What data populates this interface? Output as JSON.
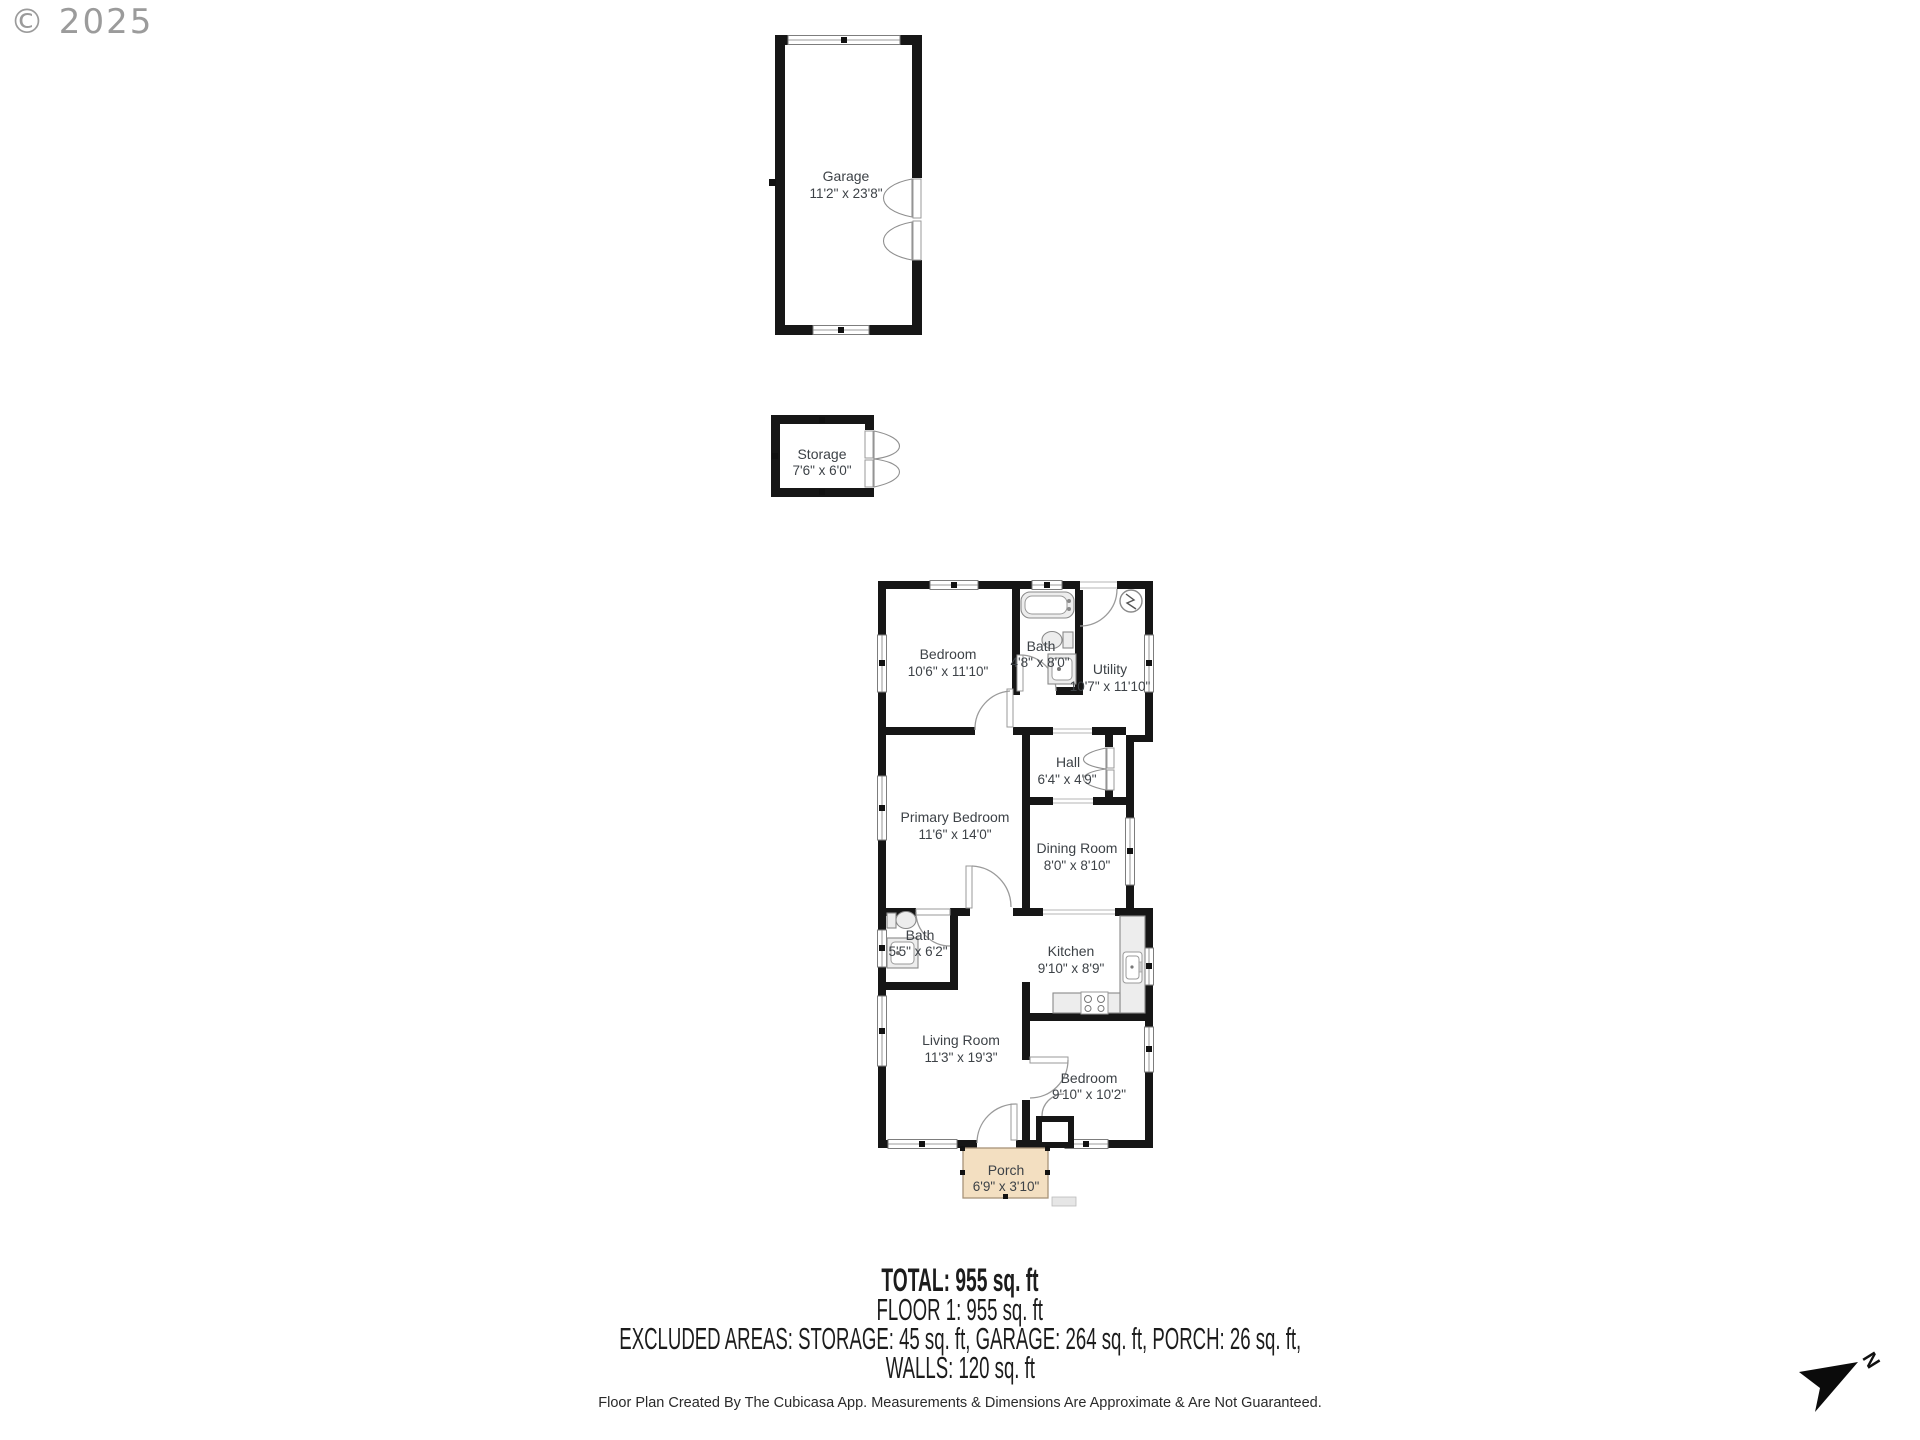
{
  "watermark": {
    "text": "© 2025"
  },
  "floor_plan": {
    "rooms": {
      "garage": {
        "name": "Garage",
        "dims": "11'2\" x 23'8\""
      },
      "storage": {
        "name": "Storage",
        "dims": "7'6\" x 6'0\""
      },
      "bedroom_top": {
        "name": "Bedroom",
        "dims": "10'6\" x 11'10\""
      },
      "bath_top": {
        "name": "Bath",
        "dims": "4'8\" x 8'0\""
      },
      "utility": {
        "name": "Utility",
        "dims": "10'7\" x 11'10\""
      },
      "hall": {
        "name": "Hall",
        "dims": "6'4\" x 4'9\""
      },
      "primary_bedroom": {
        "name": "Primary Bedroom",
        "dims": "11'6\" x 14'0\""
      },
      "dining_room": {
        "name": "Dining Room",
        "dims": "8'0\" x 8'10\""
      },
      "bath_lower": {
        "name": "Bath",
        "dims": "5'5\" x 6'2\""
      },
      "kitchen": {
        "name": "Kitchen",
        "dims": "9'10\" x 8'9\""
      },
      "living_room": {
        "name": "Living Room",
        "dims": "11'3\" x 19'3\""
      },
      "bedroom_lower": {
        "name": "Bedroom",
        "dims": "9'10\" x 10'2\""
      },
      "porch": {
        "name": "Porch",
        "dims": "6'9\" x 3'10\""
      }
    }
  },
  "summary": {
    "total": "TOTAL: 955 sq. ft",
    "floor": "FLOOR 1: 955 sq. ft",
    "excluded": "EXCLUDED AREAS: STORAGE: 45 sq. ft, GARAGE: 264 sq. ft, PORCH: 26 sq. ft,",
    "walls": "WALLS: 120 sq. ft"
  },
  "footer": {
    "text": "Floor Plan Created By The Cubicasa App. Measurements & Dimensions Are Approximate & Are Not Guaranteed."
  },
  "compass": {
    "label": "N"
  },
  "colors": {
    "wall": "#161616",
    "porch_fill": "#f3dfc1",
    "porch_border": "#a8937a",
    "fixture_fill": "#ededed",
    "label_text": "#3d4247",
    "watermark": "#9b9b9b"
  }
}
